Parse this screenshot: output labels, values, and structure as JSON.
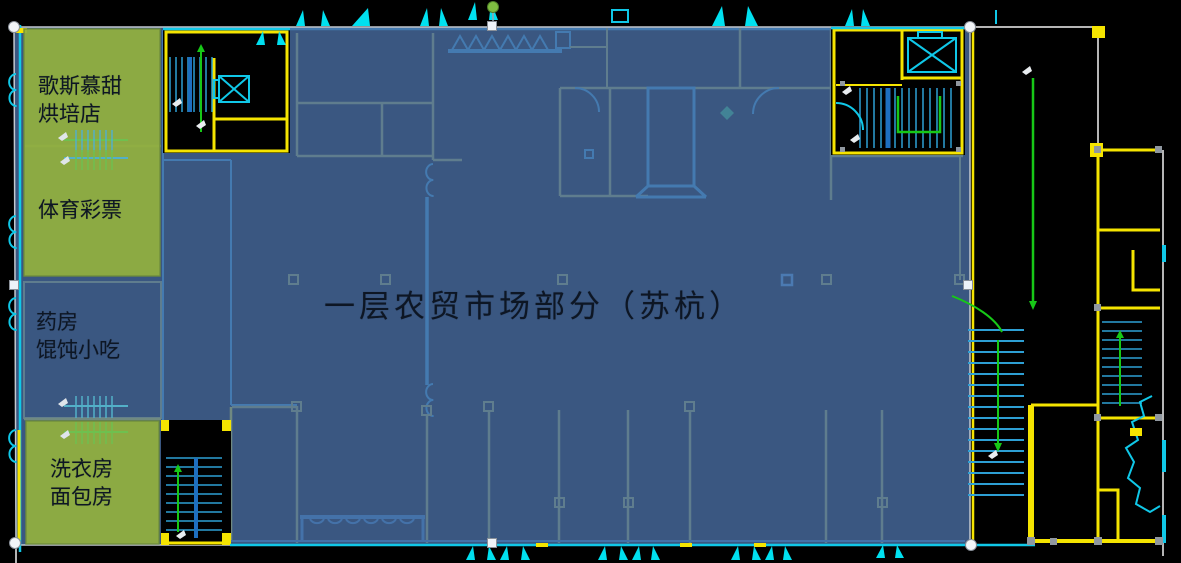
{
  "scene": {
    "description": "CAD floor plan screenshot on a slide; a semi-transparent blue polygon covering the market area is selected (white corner/edge handles, green rotation knob); green highlight rectangles mark shops on the left",
    "canvas": {
      "width": 1181,
      "height": 563
    }
  },
  "title": {
    "text": "一层农贸市场部分（苏杭）",
    "color": "#0d1624"
  },
  "shops": {
    "bakery": {
      "line1": "歌斯慕甜",
      "line2": "烘培店"
    },
    "lottery": {
      "line1": "体育彩票"
    },
    "pharmacy": {
      "line1": "药房",
      "line2": "馄饨小吃"
    },
    "laundry": {
      "line1": "洗衣房",
      "line2": "面包房"
    }
  },
  "selection": {
    "shape": "blue-overlay-polygon",
    "handle_style": {
      "corner": "white-circle",
      "edge": "white-square",
      "rotation": "green-circle"
    },
    "handles": [
      {
        "type": "rotation",
        "x": 493,
        "y": 7
      },
      {
        "type": "corner",
        "x": 14,
        "y": 27
      },
      {
        "type": "corner",
        "x": 970,
        "y": 27
      },
      {
        "type": "corner",
        "x": 15,
        "y": 543
      },
      {
        "type": "corner",
        "x": 971,
        "y": 545
      },
      {
        "type": "edge",
        "x": 492,
        "y": 26
      },
      {
        "type": "edge",
        "x": 14,
        "y": 285
      },
      {
        "type": "edge",
        "x": 968,
        "y": 285
      },
      {
        "type": "edge",
        "x": 492,
        "y": 543
      }
    ]
  },
  "colors": {
    "background": "#000000",
    "overlay_blue": "#4a6fa5",
    "highlight_green": "#92b03e",
    "cad_cyan": "#10c8e8",
    "cad_yellow": "#f5e400",
    "cad_olive": "#a8ae3c",
    "cad_green": "#17c817",
    "outline_gray": "#c3c9cf",
    "handle_fill": "#f2f5f8",
    "rotation_green": "#7fbe41"
  }
}
